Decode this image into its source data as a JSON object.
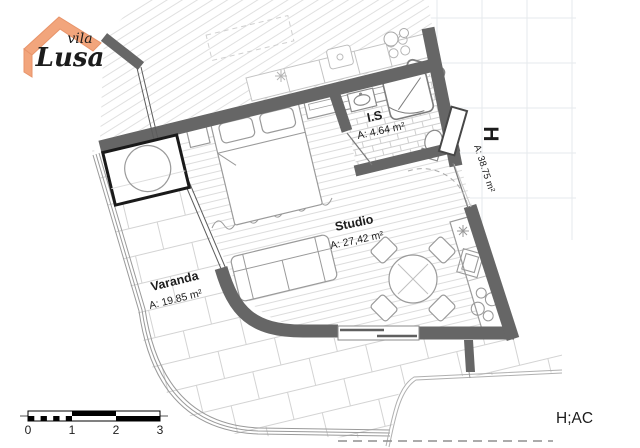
{
  "logo": {
    "line1": "vila",
    "line2": "Lusa"
  },
  "plan": {
    "unit_label": "H",
    "unit_area": "A: 38.75 m²",
    "rooms": [
      {
        "name": "I.S",
        "area": "A: 4.64 m²"
      },
      {
        "name": "Studio",
        "area": "A: 27,42 m²"
      },
      {
        "name": "Varanda",
        "area": "A: 19.85 m²"
      }
    ]
  },
  "scale_bar": {
    "ticks": [
      "0",
      "1",
      "2",
      "3"
    ]
  },
  "sheet_code": "H;AC",
  "colors": {
    "wall": "#666666",
    "unit_label_blue": "#5b9bd5",
    "logo_orange": "#f2a57c",
    "logo_teal": "#3f8fa3"
  }
}
